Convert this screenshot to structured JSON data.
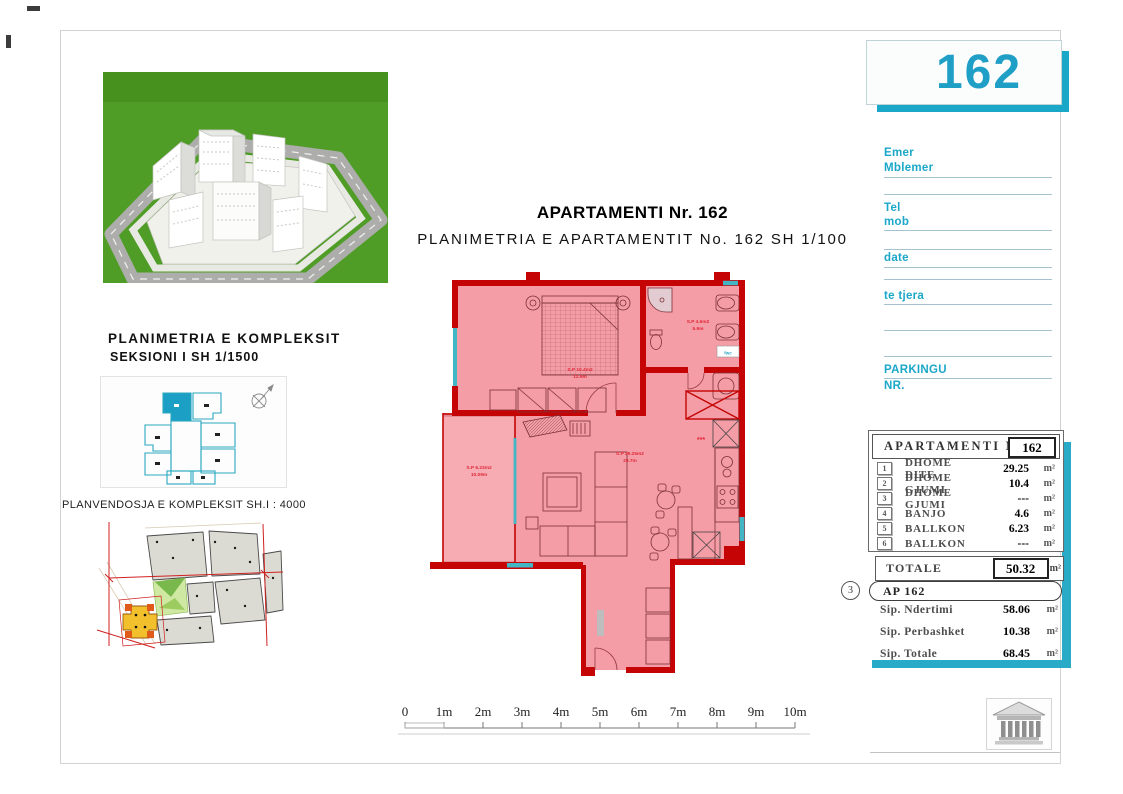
{
  "sheet": {
    "number": "162"
  },
  "titles": {
    "main": "APARTAMENTI Nr. 162",
    "sub": "PLANIMETRIA E APARTAMENTIT No. 162 SH 1/100"
  },
  "left_panel": {
    "heading_line1": "PLANIMETRIA E KOMPLEKSIT",
    "heading_line2": "SEKSIONI I SH 1/1500",
    "site_label": "PLANVENDOSJA E KOMPLEKSIT SH.I : 4000"
  },
  "form": {
    "labels": [
      "Emer",
      "Mblemer",
      "Tel",
      "mob",
      "date",
      "te tjera",
      "PARKINGU",
      "NR."
    ]
  },
  "table": {
    "title": "APARTAMENTI  NR.",
    "number": "162",
    "rows": [
      {
        "no": "1",
        "name": "DHOME DITE",
        "value": "29.25",
        "unit": "m²"
      },
      {
        "no": "2",
        "name": "DHOME GJUMI",
        "value": "10.4",
        "unit": "m²"
      },
      {
        "no": "3",
        "name": "DHOME GJUMI",
        "value": "---",
        "unit": "m²"
      },
      {
        "no": "4",
        "name": "BANJO",
        "value": "4.6",
        "unit": "m²"
      },
      {
        "no": "5",
        "name": "BALLKON",
        "value": "6.23",
        "unit": "m²"
      },
      {
        "no": "6",
        "name": "BALLKON",
        "value": "---",
        "unit": "m²"
      }
    ],
    "totale_label": "TOTALE",
    "totale_value": "50.32",
    "totale_unit": "m²"
  },
  "summary": {
    "marker": "3",
    "ap_label": "AP 162",
    "rows": [
      {
        "name": "Sip. Ndertimi",
        "value": "58.06",
        "unit": "m²"
      },
      {
        "name": "Sip. Perbashket",
        "value": "10.38",
        "unit": "m²"
      },
      {
        "name": "Sip. Totale",
        "value": "68.45",
        "unit": "m²"
      }
    ]
  },
  "plan": {
    "rooms": [
      {
        "name": "dhome-gjumi",
        "area": "S.P 10.4m2",
        "perimeter": "12.9m"
      },
      {
        "name": "banjo",
        "area": "S.P 4.6m2",
        "perimeter": "5.9m"
      },
      {
        "name": "dhome-dite",
        "area": "S.P 29.25m2",
        "perimeter": "29.7m"
      },
      {
        "name": "ballkon",
        "area": "S.P 6.23m2",
        "perimeter": "10.09m"
      }
    ],
    "annotations": {
      "stars": "***",
      "fwc": "fwc"
    }
  },
  "scale_bar": {
    "ticks": [
      "0",
      "1m",
      "2m",
      "3m",
      "4m",
      "5m",
      "6m",
      "7m",
      "8m",
      "9m",
      "10m"
    ]
  },
  "colors": {
    "accent_teal": "#1ba7c8",
    "wall_red": "#c50505",
    "plan_fill": "#f49da6",
    "label_red": "#e02838"
  }
}
